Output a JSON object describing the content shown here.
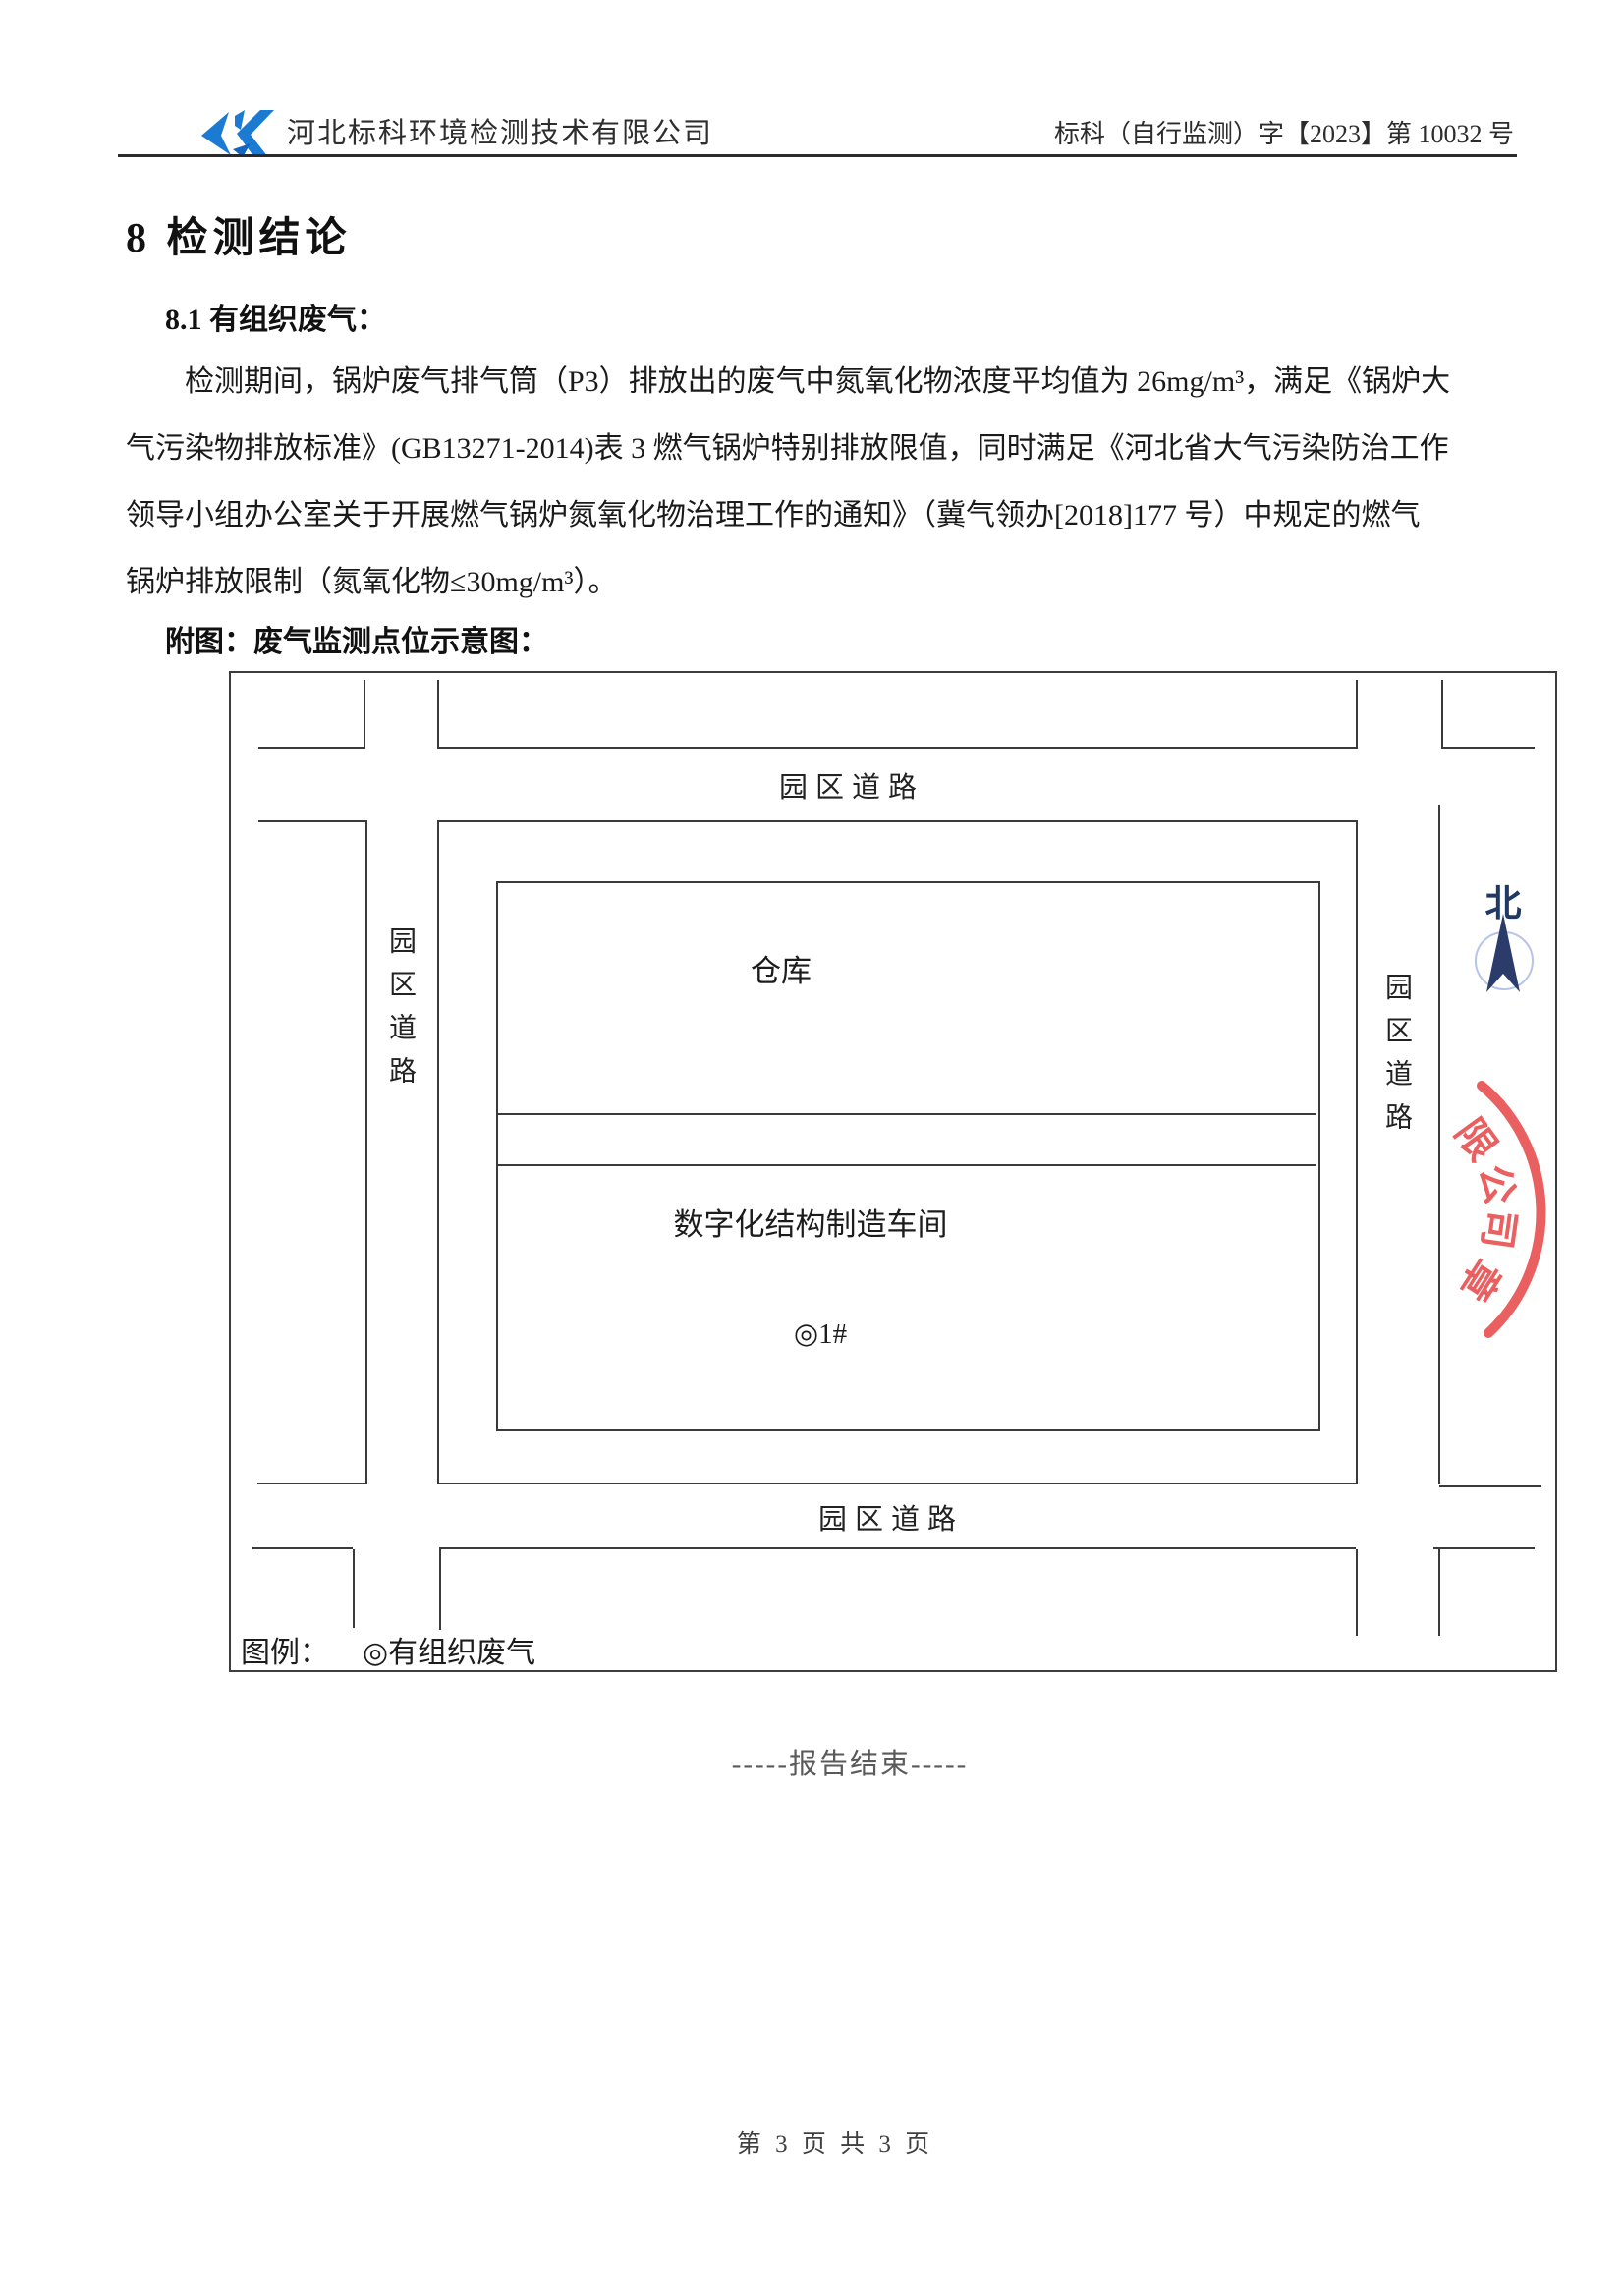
{
  "header": {
    "company": "河北标科环境检测技术有限公司",
    "doc_number": "标科（自行监测）字【2023】第 10032 号"
  },
  "section": {
    "title": "8  检测结论",
    "subsection": "8.1 有组织废气："
  },
  "paragraph": {
    "lines": [
      "检测期间，锅炉废气排气筒（P3）排放出的废气中氮氧化物浓度平均值为 26mg/m³，满足《锅炉大",
      "气污染物排放标准》(GB13271-2014)表 3 燃气锅炉特别排放限值，同时满足《河北省大气污染防治工作",
      "领导小组办公室关于开展燃气锅炉氮氧化物治理工作的通知》（冀气领办[2018]177 号）中规定的燃气",
      "锅炉排放限制（氮氧化物≤30mg/m³）。"
    ]
  },
  "figure": {
    "caption": "附图：废气监测点位示意图：",
    "road_label": "园区道路",
    "buildings": {
      "warehouse": "仓库",
      "workshop": "数字化结构制造车间",
      "monitoring_point": "◎1#"
    },
    "legend": {
      "label": "图例：",
      "item": "◎有组织废气"
    },
    "compass": {
      "north": "北"
    },
    "stamp": {
      "chars": [
        "限",
        "公",
        "司",
        "章"
      ],
      "color": "#e84a4a"
    },
    "colors": {
      "compass_arrow": "#2b3c6b",
      "compass_circle": "#b6c4e6",
      "logo_blue": "#1b7ad2",
      "stamp_red": "#e84a4a"
    }
  },
  "footer": {
    "end_note": "-----报告结束-----",
    "page": "第 3 页 共 3 页"
  }
}
